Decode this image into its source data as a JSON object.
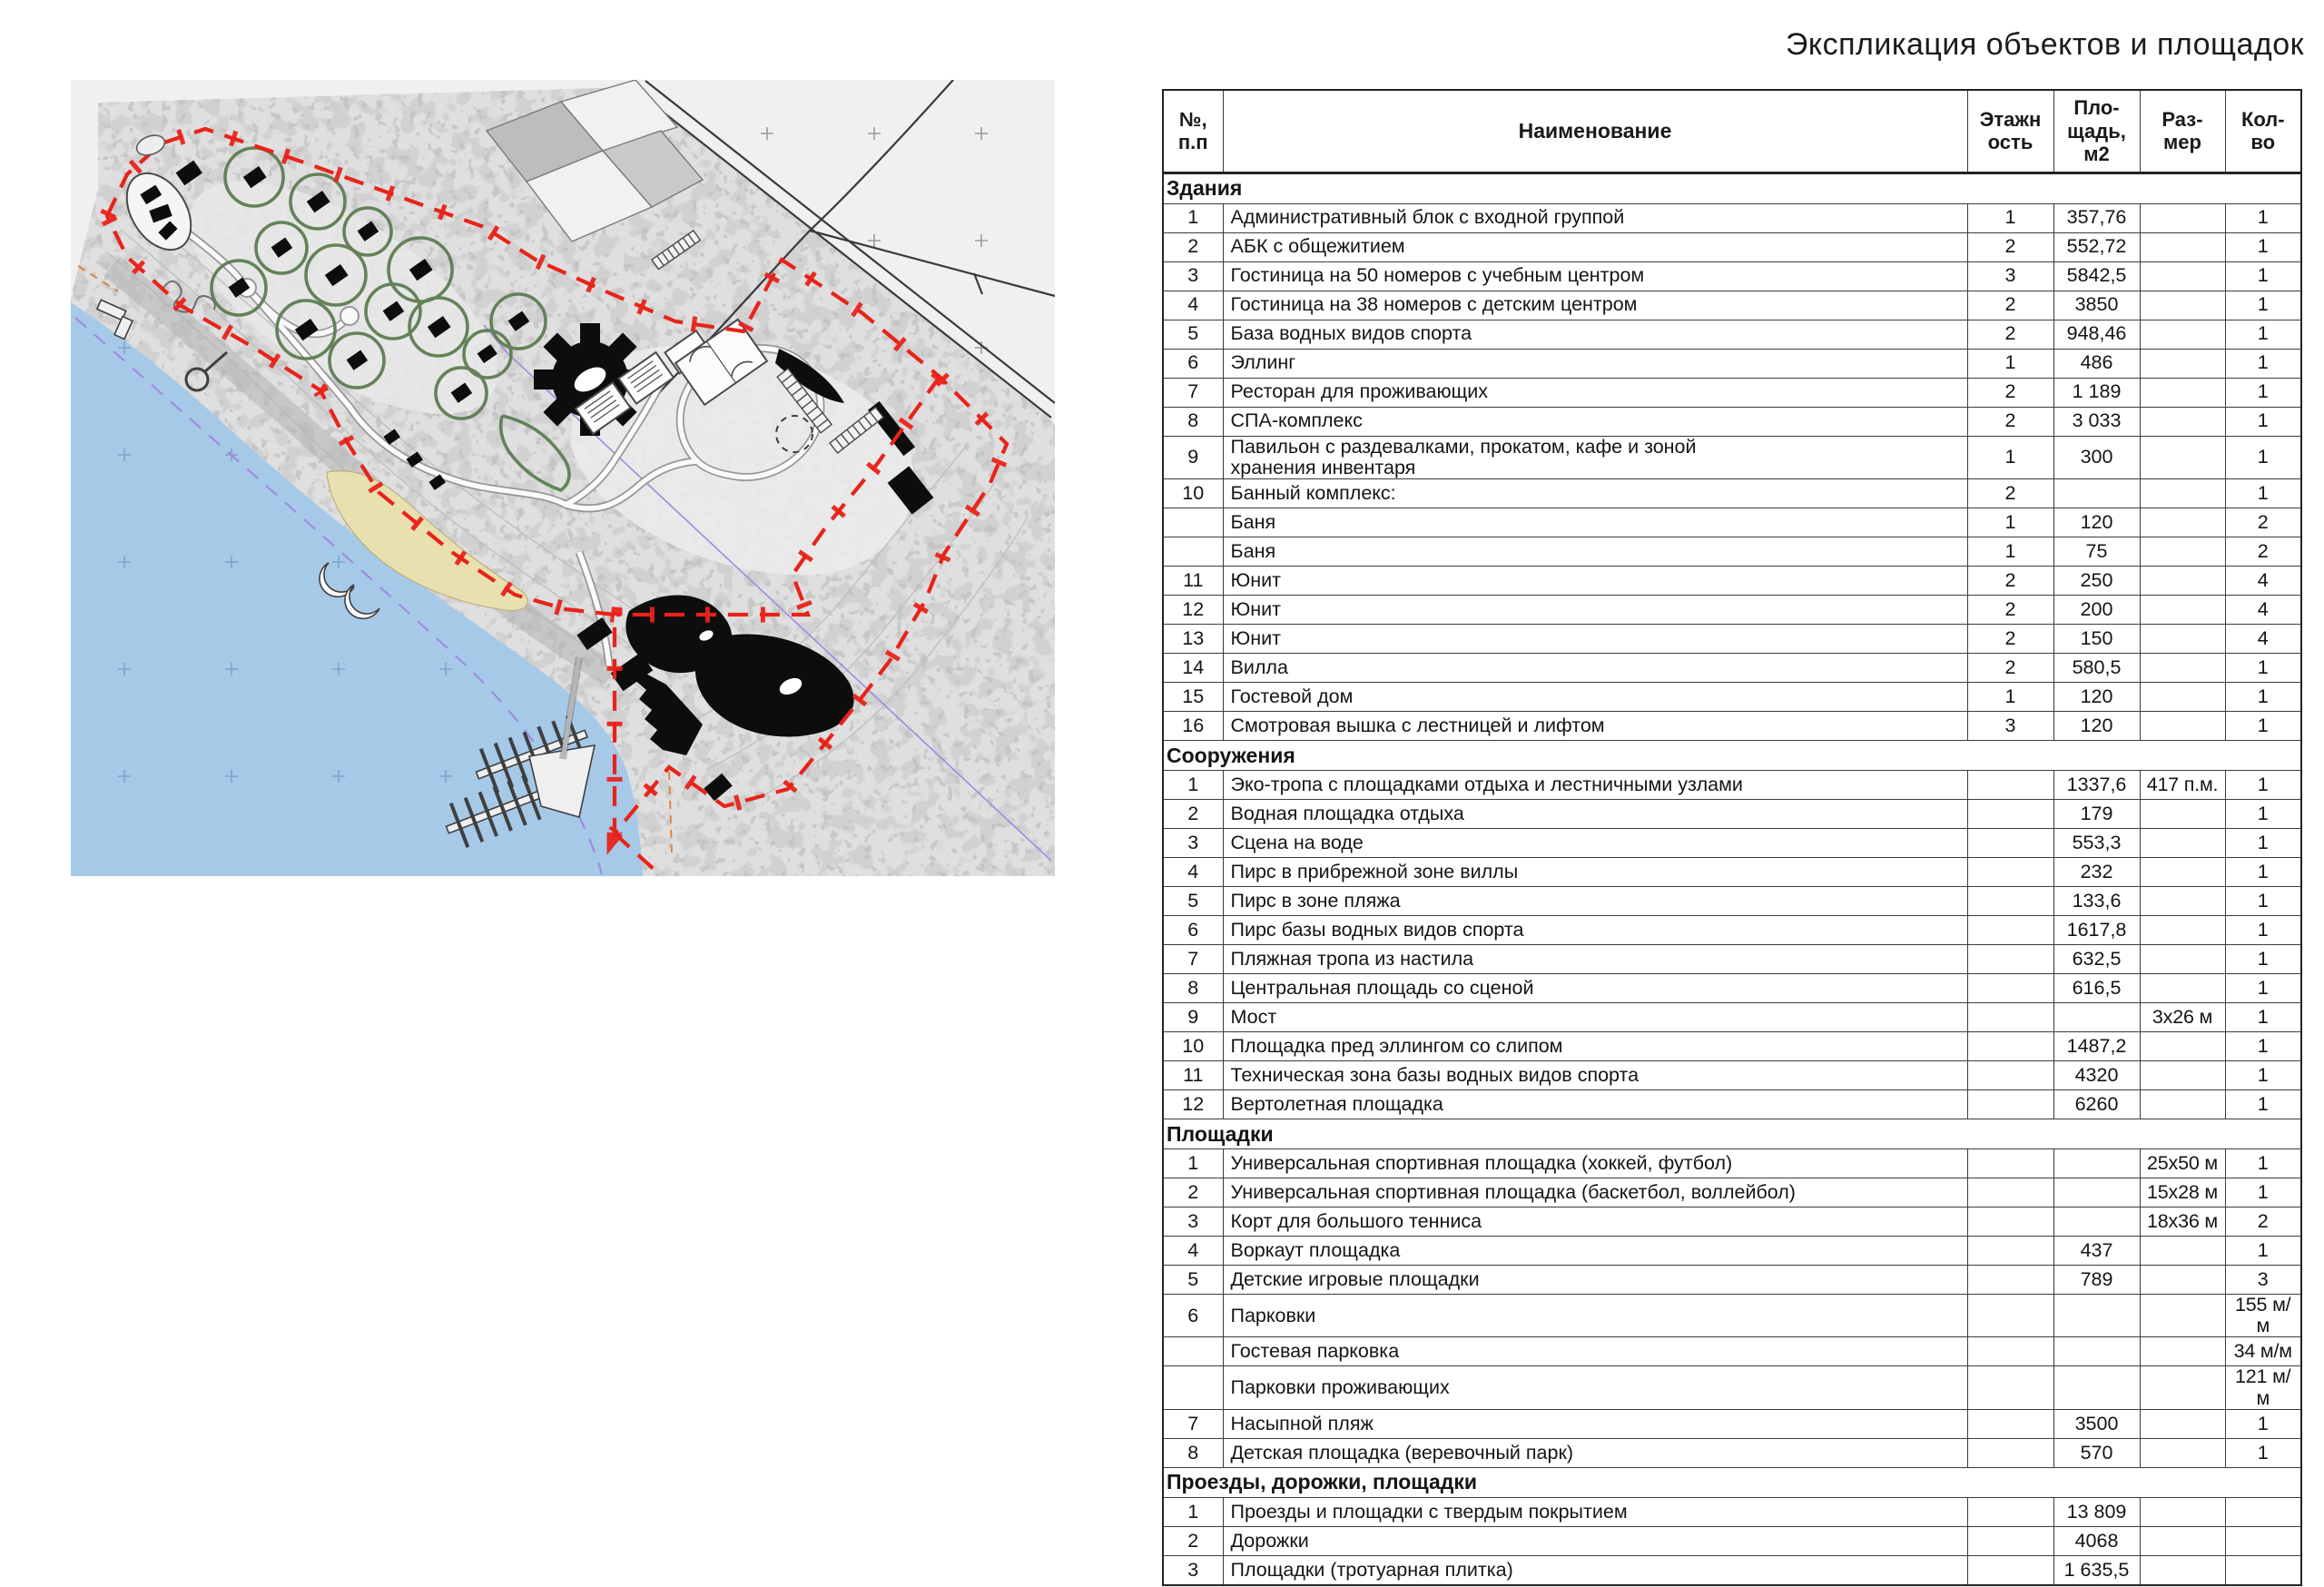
{
  "page": {
    "title": "Экспликация объектов и площадок"
  },
  "colors": {
    "boundary_red": "#e8231a",
    "water_blue": "#a6c9e8",
    "forest_gray": "#dfdfdf",
    "open_field_gray": "#f0f0f0",
    "beach_sand": "#e9e0b0",
    "landscape_green": "#5d7d52",
    "building_black": "#0d0d0d",
    "utility_purple": "#a08ae0",
    "utility_orange": "#e2833a"
  },
  "map": {
    "features": [
      "site-boundary",
      "lake-water",
      "forest",
      "open-field",
      "beach",
      "landscape-circles",
      "cabin-buildings",
      "hotel-gear-building",
      "sport-courts",
      "helipad",
      "marina-piers",
      "slipway",
      "roads",
      "field-plots"
    ]
  },
  "table": {
    "header": {
      "num": "№,\nп.п",
      "name": "Наименование",
      "floors": "Этажн\nость",
      "area": "Пло-\nщадь,\nм2",
      "size": "Раз-\nмер",
      "qty": "Кол-\nво"
    },
    "sections": [
      {
        "title": "Здания",
        "rows": [
          {
            "n": "1",
            "name": "Административный блок с входной группой",
            "fl": "1",
            "ar": "357,76",
            "sz": "",
            "q": "1"
          },
          {
            "n": "2",
            "name": "АБК с общежитием",
            "fl": "2",
            "ar": "552,72",
            "sz": "",
            "q": "1"
          },
          {
            "n": "3",
            "name": "Гостиница на 50 номеров с учебным центром",
            "fl": "3",
            "ar": "5842,5",
            "sz": "",
            "q": "1"
          },
          {
            "n": "4",
            "name": "Гостиница на 38 номеров с детским центром",
            "fl": "2",
            "ar": "3850",
            "sz": "",
            "q": "1"
          },
          {
            "n": "5",
            "name": "База водных видов спорта",
            "fl": "2",
            "ar": "948,46",
            "sz": "",
            "q": "1"
          },
          {
            "n": "6",
            "name": "Эллинг",
            "fl": "1",
            "ar": "486",
            "sz": "",
            "q": "1"
          },
          {
            "n": "7",
            "name": "Ресторан для проживающих",
            "fl": "2",
            "ar": "1 189",
            "sz": "",
            "q": "1"
          },
          {
            "n": "8",
            "name": "СПА-комплекс",
            "fl": "2",
            "ar": "3 033",
            "sz": "",
            "q": "1"
          },
          {
            "n": "9",
            "name": "Павильон с раздевалками, прокатом, кафе и зоной\nхранения инвентаря",
            "fl": "1",
            "ar": "300",
            "sz": "",
            "q": "1"
          },
          {
            "n": "10",
            "name": "Банный комплекс:",
            "fl": "2",
            "ar": "",
            "sz": "",
            "q": "1"
          },
          {
            "n": "",
            "name": "Баня",
            "fl": "1",
            "ar": "120",
            "sz": "",
            "q": "2"
          },
          {
            "n": "",
            "name": "Баня",
            "fl": "1",
            "ar": "75",
            "sz": "",
            "q": "2"
          },
          {
            "n": "11",
            "name": "Юнит",
            "fl": "2",
            "ar": "250",
            "sz": "",
            "q": "4"
          },
          {
            "n": "12",
            "name": "Юнит",
            "fl": "2",
            "ar": "200",
            "sz": "",
            "q": "4"
          },
          {
            "n": "13",
            "name": "Юнит",
            "fl": "2",
            "ar": "150",
            "sz": "",
            "q": "4"
          },
          {
            "n": "14",
            "name": "Вилла",
            "fl": "2",
            "ar": "580,5",
            "sz": "",
            "q": "1"
          },
          {
            "n": "15",
            "name": "Гостевой дом",
            "fl": "1",
            "ar": "120",
            "sz": "",
            "q": "1"
          },
          {
            "n": "16",
            "name": "Смотровая вышка с лестницей и лифтом",
            "fl": "3",
            "ar": "120",
            "sz": "",
            "q": "1"
          }
        ]
      },
      {
        "title": "Сооружения",
        "rows": [
          {
            "n": "1",
            "name": "Эко-тропа с площадками отдыха и лестничными узлами",
            "fl": "",
            "ar": "1337,6",
            "sz": "417 п.м.",
            "q": "1"
          },
          {
            "n": "2",
            "name": "Водная площадка отдыха",
            "fl": "",
            "ar": "179",
            "sz": "",
            "q": "1"
          },
          {
            "n": "3",
            "name": "Сцена на воде",
            "fl": "",
            "ar": "553,3",
            "sz": "",
            "q": "1"
          },
          {
            "n": "4",
            "name": "Пирс в прибрежной зоне виллы",
            "fl": "",
            "ar": "232",
            "sz": "",
            "q": "1"
          },
          {
            "n": "5",
            "name": "Пирс в зоне пляжа",
            "fl": "",
            "ar": "133,6",
            "sz": "",
            "q": "1"
          },
          {
            "n": "6",
            "name": "Пирс базы водных видов спорта",
            "fl": "",
            "ar": "1617,8",
            "sz": "",
            "q": "1"
          },
          {
            "n": "7",
            "name": "Пляжная тропа из настила",
            "fl": "",
            "ar": "632,5",
            "sz": "",
            "q": "1"
          },
          {
            "n": "8",
            "name": "Центральная площадь со сценой",
            "fl": "",
            "ar": "616,5",
            "sz": "",
            "q": "1"
          },
          {
            "n": "9",
            "name": "Мост",
            "fl": "",
            "ar": "",
            "sz": "3х26 м",
            "q": "1"
          },
          {
            "n": "10",
            "name": "Площадка пред эллингом со слипом",
            "fl": "",
            "ar": "1487,2",
            "sz": "",
            "q": "1"
          },
          {
            "n": "11",
            "name": "Техническая зона базы водных видов спорта",
            "fl": "",
            "ar": "4320",
            "sz": "",
            "q": "1"
          },
          {
            "n": "12",
            "name": "Вертолетная площадка",
            "fl": "",
            "ar": "6260",
            "sz": "",
            "q": "1"
          }
        ]
      },
      {
        "title": "Площадки",
        "rows": [
          {
            "n": "1",
            "name": "Универсальная спортивная площадка (хоккей, футбол)",
            "fl": "",
            "ar": "",
            "sz": "25х50 м",
            "q": "1"
          },
          {
            "n": "2",
            "name": "Универсальная спортивная площадка (баскетбол, воллейбол)",
            "fl": "",
            "ar": "",
            "sz": "15х28 м",
            "q": "1"
          },
          {
            "n": "3",
            "name": "Корт для большого тенниса",
            "fl": "",
            "ar": "",
            "sz": "18х36 м",
            "q": "2"
          },
          {
            "n": "4",
            "name": "Воркаут площадка",
            "fl": "",
            "ar": "437",
            "sz": "",
            "q": "1"
          },
          {
            "n": "5",
            "name": "Детские игровые площадки",
            "fl": "",
            "ar": "789",
            "sz": "",
            "q": "3"
          },
          {
            "n": "6",
            "name": "Парковки",
            "fl": "",
            "ar": "",
            "sz": "",
            "q": "155 м/м"
          },
          {
            "n": "",
            "name": "Гостевая парковка",
            "fl": "",
            "ar": "",
            "sz": "",
            "q": "34 м/м"
          },
          {
            "n": "",
            "name": "Парковки проживающих",
            "fl": "",
            "ar": "",
            "sz": "",
            "q": "121 м/м"
          },
          {
            "n": "7",
            "name": "Насыпной пляж",
            "fl": "",
            "ar": "3500",
            "sz": "",
            "q": "1"
          },
          {
            "n": "8",
            "name": "Детская площадка (веревочный парк)",
            "fl": "",
            "ar": "570",
            "sz": "",
            "q": "1"
          }
        ]
      },
      {
        "title": "Проезды, дорожки, площадки",
        "rows": [
          {
            "n": "1",
            "name": "Проезды и площадки с твердым покрытием",
            "fl": "",
            "ar": "13 809",
            "sz": "",
            "q": ""
          },
          {
            "n": "2",
            "name": "Дорожки",
            "fl": "",
            "ar": "4068",
            "sz": "",
            "q": ""
          },
          {
            "n": "3",
            "name": "Площадки (тротуарная плитка)",
            "fl": "",
            "ar": "1 635,5",
            "sz": "",
            "q": ""
          }
        ]
      }
    ]
  }
}
